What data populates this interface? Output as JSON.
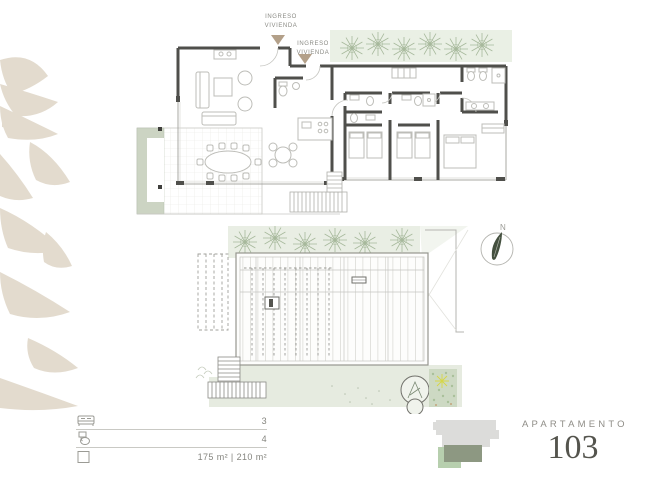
{
  "title_block": {
    "label": "APARTAMENTO",
    "number": "103"
  },
  "plan_labels": {
    "entry_1": "INGRESO\nVIVIENDA",
    "entry_2": "INGRESO\nVIVIENDA"
  },
  "compass": {
    "north": "N"
  },
  "legend": {
    "rows": [
      {
        "name": "bedrooms",
        "icon": "bed-icon",
        "value": "3"
      },
      {
        "name": "bathrooms",
        "icon": "toilet-icon",
        "value": "4"
      },
      {
        "name": "area",
        "icon": "area-icon",
        "value": "175 m² | 210 m²"
      }
    ]
  },
  "key_plan": {
    "base_color": "#dcdcda",
    "highlight_color": "#8d9882",
    "secondary_color": "#b7cfae"
  },
  "decor": {
    "palm_color": "#e3dbce",
    "greenery_fill": "#e9eee4",
    "terrace_green": "#e6ebe0",
    "entry_arrow_color": "#b3a089"
  }
}
